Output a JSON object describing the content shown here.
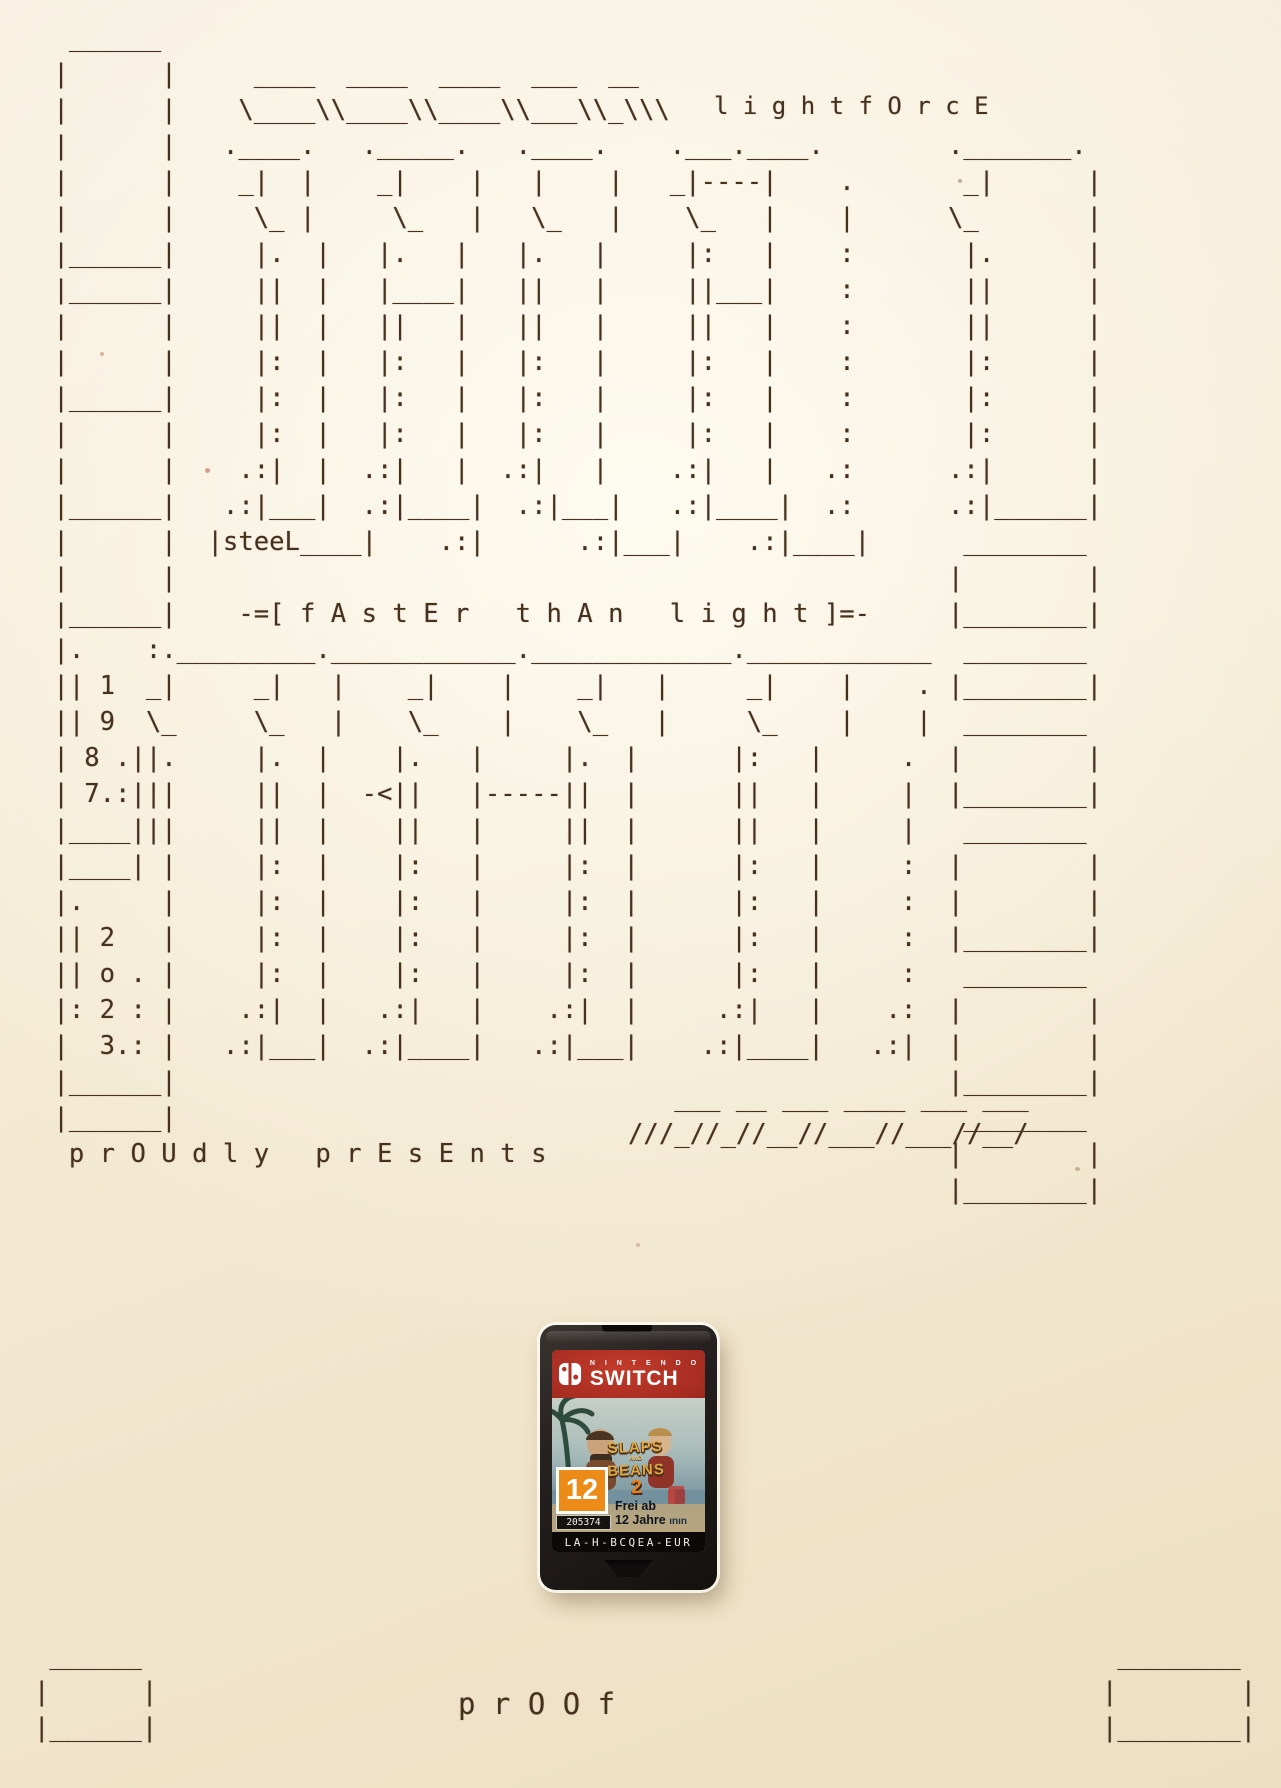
{
  "page": {
    "paper_color": "#f4ead3",
    "ink_color": "#46311f"
  },
  "ascii_blocks": [
    {
      "name": "main-logo-art",
      "x": 38,
      "y": 20,
      "size": 25.6,
      "lines": [
        "  ______",
        " |      |     ____  ____  ____  ___  __",
        " |      |    \\____\\\\____\\\\____\\\\___\\\\_\\\\\\",
        " |      |   .____.   ._____.   .____.    .___.____.",
        " |      |    _|  |    _|    |   |    |   _|----|    .",
        " |      |     \\_ |     \\_   |   \\_   |    \\_   |    |",
        " |______|     |.  |   |.   |   |.   |     |:   |    :",
        " |______|     ||  |   |____|   ||   |     ||___|    :",
        " |      |     ||  |   ||   |   ||   |     ||   |    :",
        " |      |     |:  |   |:   |   |:   |     |:   |    :",
        " |______|     |:  |   |:   |   |:   |     |:   |    :",
        " |      |     |:  |   |:   |   |:   |     |:   |    :",
        " |      |    .:|  |  .:|   |  .:|   |    .:|   |   .:",
        " |______|   .:|___|  .:|____|  .:|___|   .:|____|  .:",
        " |      |  |steeL____|    .:|      .:|___|    .:|____|",
        " |      |",
        " |______|    -=[ f A s t E r   t h A n   l i g h t ]=-",
        " |.    :._________.____________._____________.____________",
        " || 1  _|     _|   |    _|    |    _|   |     _|    |    .",
        " || 9  \\_     \\_   |    \\_    |    \\_   |     \\_    |    |",
        " | 8 .||.     |.  |    |.   |     |.  |      |:   |     .",
        " | 7.:|||     ||  |  -<||   |-----||  |      ||   |     |",
        " |____|||     ||  |    ||   |     ||  |      ||   |     |",
        " |____| |     |:  |    |:   |     |:  |      |:   |     :",
        " |.     |     |:  |    |:   |     |:  |      |:   |     :",
        " || 2   |     |:  |    |:   |     |:  |      |:   |     :",
        " || o . |     |:  |    |:   |     |:  |      |:   |     :",
        " |: 2 : |    .:|  |   .:|   |    .:|  |     .:|   |    .:",
        " |  3.: |   .:|___|  .:|____|   .:|___|    .:|____|   .:|",
        " |______|",
        " |______|",
        "  p r O U d l y   p r E s E n t s"
      ]
    },
    {
      "name": "lightforce-wordmark",
      "x": 714,
      "y": 88,
      "size": 24,
      "lines": [
        "l i g h t f O r c E"
      ]
    },
    {
      "name": "right-filmstrip",
      "x": 948,
      "y": 128,
      "size": 25.6,
      "lines": [
        "._______.",
        " _|      |",
        "\\_       |",
        " |.      |",
        " ||      |",
        " ||      |",
        " |:      |",
        " |:      |",
        " |:      |",
        ".:|      |",
        ".:|______|",
        " ________",
        "|        |",
        "|________|",
        " ________",
        "|________|",
        " ________",
        "|        |",
        "|________|",
        " ________",
        "|        |",
        "|        |",
        "|________|",
        " ________",
        "|        |",
        "|        |",
        "|________|",
        " ________",
        "|        |",
        "|________|"
      ]
    },
    {
      "name": "mini-slash-logo",
      "x": 628,
      "y": 1080,
      "size": 25.6,
      "lines": [
        "   ___ __ ___ ____ ___ ___",
        "///_//_//__//___//___//__/"
      ]
    },
    {
      "name": "bottom-left-corner-box",
      "x": 34,
      "y": 1638,
      "size": 25.6,
      "lines": [
        " ______",
        "|      |",
        "|______|"
      ]
    },
    {
      "name": "bottom-right-corner-box",
      "x": 1102,
      "y": 1638,
      "size": 25.6,
      "lines": [
        " ________",
        "|        |",
        "|________|"
      ]
    },
    {
      "name": "proof-wordmark",
      "x": 458,
      "y": 1686,
      "size": 29,
      "lines": [
        "p r O O f"
      ]
    }
  ],
  "cartridge": {
    "brand_small": "N I N T E N D O",
    "brand_big": "SWITCH",
    "subtitle": "Bud Spencer & Terence Hill",
    "title_line1": "SLAPS",
    "title_line2": "AND",
    "title_line3": "BEANS",
    "title_number": "2",
    "rating_number": "12",
    "rating_code": "205374",
    "rating_line1": "Frei ab",
    "rating_line2": "12 Jahre",
    "rating_extra": "ının",
    "code": "LA-H-BCQEA-EUR",
    "colors": {
      "band_red": "#a82d22",
      "body_black": "#1b1715",
      "usk_orange": "#ec8b17",
      "label_sky": "#a9bbb9"
    }
  }
}
